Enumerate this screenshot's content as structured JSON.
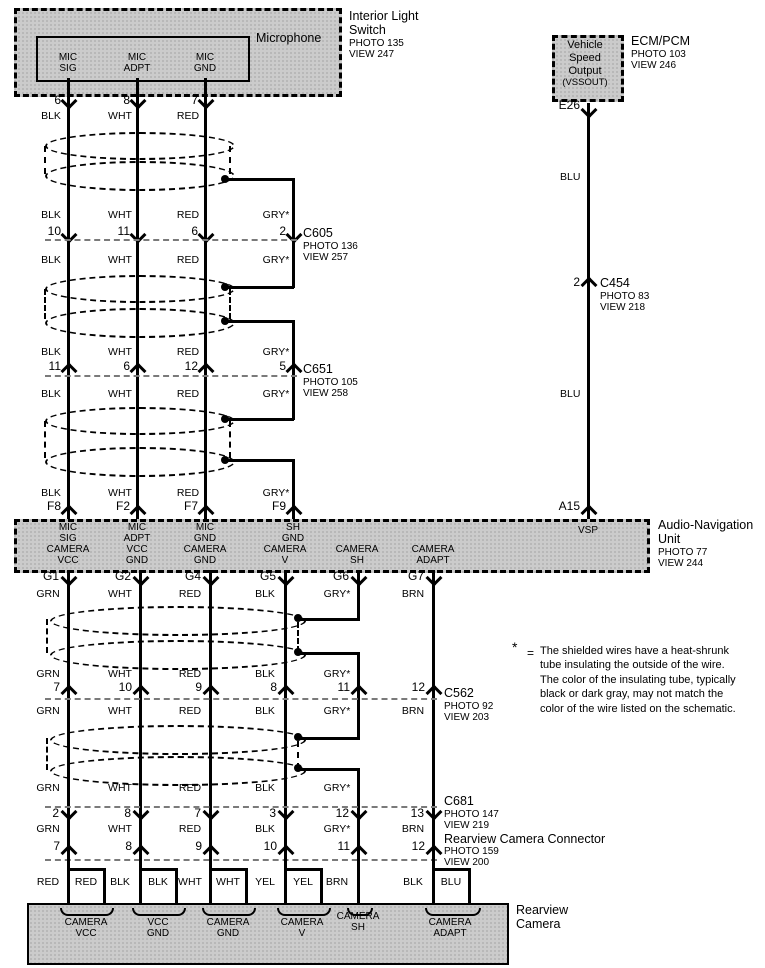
{
  "diagram": {
    "interior_light_switch": {
      "title_lines": [
        "Interior Light",
        "Switch"
      ],
      "photo": "PHOTO 135",
      "view": "VIEW 247"
    },
    "microphone": {
      "label": "Microphone",
      "pins": [
        {
          "terminal": "MIC\nSIG",
          "num": "6",
          "color": "BLK"
        },
        {
          "terminal": "MIC\nADPT",
          "num": "8",
          "color": "WHT"
        },
        {
          "terminal": "MIC\nGND",
          "num": "7",
          "color": "RED"
        }
      ]
    },
    "ecm_pcm": {
      "title": "ECM/PCM",
      "photo": "PHOTO 103",
      "view": "VIEW 246",
      "box_lines": [
        "Vehicle",
        "Speed",
        "Output",
        "(VSSOUT)"
      ],
      "pin": "E26"
    },
    "vss_wire": {
      "color_upper": "BLU",
      "color_lower": "BLU",
      "pin_at_unit": "A15",
      "connector": {
        "pin": "2",
        "name": "C454",
        "photo": "PHOTO 83",
        "view": "VIEW 218"
      }
    },
    "mic_harness": {
      "colors_above_c605": [
        "BLK",
        "WHT",
        "RED",
        "GRY*"
      ],
      "c605": {
        "name": "C605",
        "photo": "PHOTO 136",
        "view": "VIEW 257",
        "pins": [
          "10",
          "11",
          "6",
          "2"
        ]
      },
      "colors_below_c605": [
        "BLK",
        "WHT",
        "RED",
        "GRY*"
      ],
      "colors_above_c651": [
        "BLK",
        "WHT",
        "RED",
        "GRY*"
      ],
      "c651": {
        "name": "C651",
        "photo": "PHOTO 105",
        "view": "VIEW 258",
        "pins": [
          "11",
          "6",
          "12",
          "5"
        ]
      },
      "colors_below_c651": [
        "BLK",
        "WHT",
        "RED",
        "GRY*"
      ],
      "colors_above_unit": [
        "BLK",
        "WHT",
        "RED",
        "GRY*"
      ],
      "unit_pins": [
        "F8",
        "F2",
        "F7",
        "F9"
      ]
    },
    "audio_nav_unit": {
      "title_lines": [
        "Audio-Navigation",
        "Unit"
      ],
      "photo": "PHOTO 77",
      "view": "VIEW 244",
      "vsp_terminal": "VSP",
      "top_terminals": [
        "MIC\nSIG",
        "MIC\nADPT",
        "MIC\nGND",
        "SH\nGND"
      ],
      "bottom_terminals": [
        "CAMERA\nVCC",
        "VCC\nGND",
        "CAMERA\nGND",
        "CAMERA\nV",
        "CAMERA\nSH",
        "CAMERA\nADAPT"
      ],
      "bottom_pins": [
        "G1",
        "G2",
        "G4",
        "G5",
        "G6",
        "G7"
      ]
    },
    "camera_harness": {
      "colors_below_unit": [
        "GRN",
        "WHT",
        "RED",
        "BLK",
        "GRY*",
        "BRN"
      ],
      "colors_above_c562": [
        "GRN",
        "WHT",
        "RED",
        "BLK",
        "GRY*"
      ],
      "c562": {
        "name": "C562",
        "photo": "PHOTO 92",
        "view": "VIEW 203",
        "pins": [
          "7",
          "10",
          "9",
          "8",
          "11",
          "12"
        ]
      },
      "colors_below_c562": [
        "GRN",
        "WHT",
        "RED",
        "BLK",
        "GRY*",
        "BRN"
      ],
      "colors_above_c681": [
        "GRN",
        "WHT",
        "RED",
        "BLK",
        "GRY*"
      ],
      "c681": {
        "name": "C681",
        "photo": "PHOTO 147",
        "view": "VIEW 219",
        "pins": [
          "2",
          "8",
          "7",
          "3",
          "12",
          "13"
        ]
      },
      "colors_above_camera_connector": [
        "GRN",
        "WHT",
        "RED",
        "BLK",
        "GRY*",
        "BRN"
      ],
      "camera_connector": {
        "name": "Rearview Camera Connector",
        "photo": "PHOTO 159",
        "view": "VIEW 200",
        "pins": [
          "7",
          "8",
          "9",
          "10",
          "11",
          "12"
        ]
      }
    },
    "rearview_camera": {
      "title_lines": [
        "Rearview",
        "Camera"
      ],
      "terminals": [
        {
          "label": "CAMERA\nVCC",
          "wires": [
            "RED",
            "RED"
          ]
        },
        {
          "label": "VCC\nGND",
          "wires": [
            "BLK",
            "BLK"
          ]
        },
        {
          "label": "CAMERA\nGND",
          "wires": [
            "WHT",
            "WHT"
          ]
        },
        {
          "label": "CAMERA\nV",
          "wires": [
            "YEL",
            "YEL"
          ]
        },
        {
          "label": "CAMERA\nSH",
          "wires": [
            "BRN"
          ]
        },
        {
          "label": "CAMERA\nADAPT",
          "wires": [
            "BLK",
            "BLU"
          ]
        }
      ]
    },
    "footnote": {
      "symbol": "*",
      "eq": "=",
      "lines": [
        "The shielded wires have a heat-shrunk",
        "tube insulating the outside of the wire.",
        "The color of the insulating tube, typically",
        "black or dark gray, may not match the",
        "color of the wire listed on the schematic."
      ]
    }
  }
}
